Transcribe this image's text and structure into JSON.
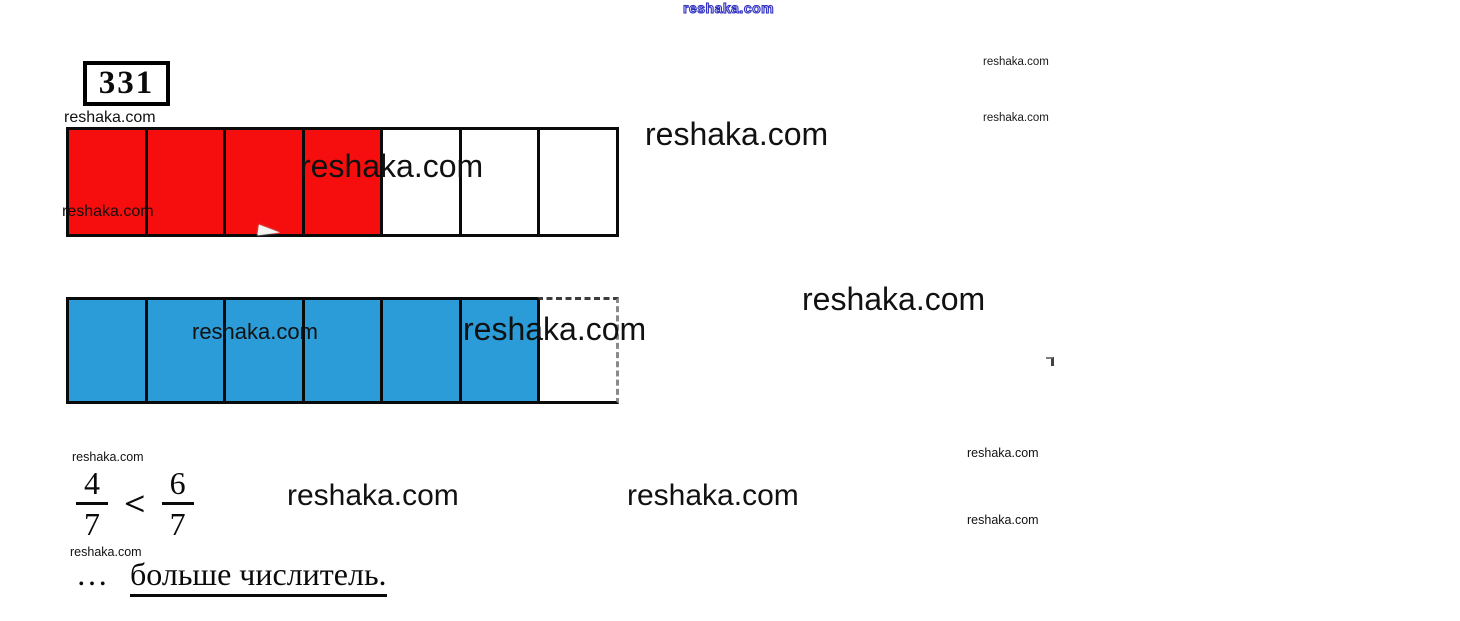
{
  "brand": {
    "watermark": "reshaka.com"
  },
  "problem": {
    "number": "331"
  },
  "bars": {
    "red": {
      "total": 7,
      "filled": 4,
      "fill_color": "#f60d0d",
      "meaning": "4/7 shaded"
    },
    "blue": {
      "total": 7,
      "filled": 6,
      "fill_color": "#2b9cd8",
      "meaning": "6/7 shaded"
    }
  },
  "comparison": {
    "left": {
      "numerator": "4",
      "denominator": "7"
    },
    "operator": "<",
    "right": {
      "numerator": "6",
      "denominator": "7"
    }
  },
  "answer": {
    "ellipsis": "…",
    "underlined": "больше числитель."
  }
}
